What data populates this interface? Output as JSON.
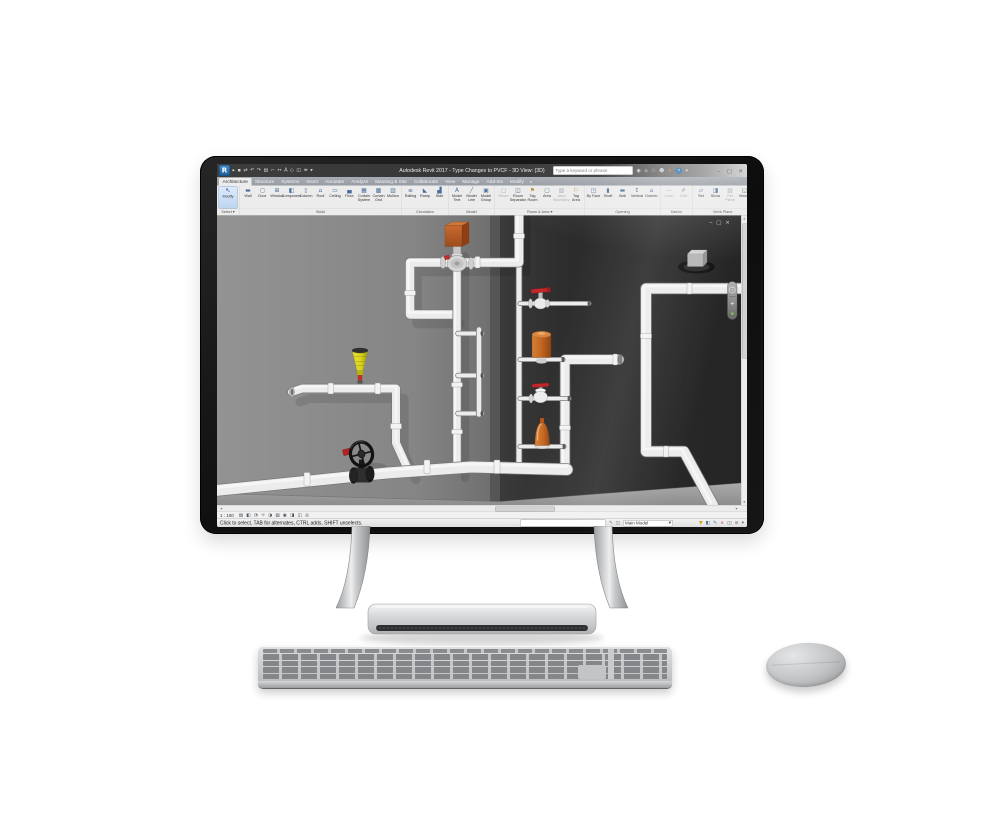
{
  "window": {
    "app_button": "R",
    "title": "Autodesk Revit 2017 - Type Changes to PVCF - 3D View: {3D}",
    "search_placeholder": "Type a keyword or phrase",
    "qat_icons": [
      {
        "name": "open",
        "glyph": "▸"
      },
      {
        "name": "save",
        "glyph": "▪"
      },
      {
        "name": "sync",
        "glyph": "⇄"
      },
      {
        "name": "undo",
        "glyph": "↶"
      },
      {
        "name": "redo",
        "glyph": "↷"
      },
      {
        "name": "print",
        "glyph": "▤"
      },
      {
        "name": "measure",
        "glyph": "⌐"
      },
      {
        "name": "aligned-dimension",
        "glyph": "↔"
      },
      {
        "name": "text",
        "glyph": "A"
      },
      {
        "name": "default-3d-view",
        "glyph": "◇"
      },
      {
        "name": "section",
        "glyph": "◫"
      },
      {
        "name": "thin-lines",
        "glyph": "≡"
      },
      {
        "name": "qat-menu",
        "glyph": "▾"
      }
    ],
    "infocenter_icons": [
      {
        "name": "search-go",
        "glyph": "◉"
      },
      {
        "name": "subscription-center",
        "glyph": "⌂"
      },
      {
        "name": "favorites",
        "glyph": "☆"
      },
      {
        "name": "sign-in",
        "glyph": "☻"
      },
      {
        "name": "exchange-apps",
        "glyph": "×"
      },
      {
        "name": "help-menu",
        "glyph": "▾"
      }
    ],
    "help_label": "?",
    "controls": {
      "minimize": "–",
      "maximize": "▢",
      "close": "×"
    }
  },
  "ribbon": {
    "tabs": [
      "Architecture",
      "Structure",
      "Systems",
      "Insert",
      "Annotate",
      "Analyze",
      "Massing & Site",
      "Collaborate",
      "View",
      "Manage",
      "Add-Ins",
      "Modify"
    ],
    "tab_caret": "▾",
    "panels": [
      {
        "name": "Select ▾",
        "buttons": [
          {
            "label": "Modify",
            "icon": "↖"
          }
        ]
      },
      {
        "name": "Build",
        "buttons": [
          {
            "label": "Wall",
            "icon": "▬"
          },
          {
            "label": "Door",
            "icon": "◻"
          },
          {
            "label": "Window",
            "icon": "⊞"
          },
          {
            "label": "Component",
            "icon": "◧"
          },
          {
            "label": "Column",
            "icon": "▯"
          },
          {
            "label": "Roof",
            "icon": "⌂"
          },
          {
            "label": "Ceiling",
            "icon": "▭"
          },
          {
            "label": "Floor",
            "icon": "▄"
          },
          {
            "label": "Curtain System",
            "icon": "▦"
          },
          {
            "label": "Curtain Grid",
            "icon": "▩"
          },
          {
            "label": "Mullion",
            "icon": "▥"
          }
        ]
      },
      {
        "name": "Circulation",
        "buttons": [
          {
            "label": "Railing",
            "icon": "≡"
          },
          {
            "label": "Ramp",
            "icon": "◣"
          },
          {
            "label": "Stair",
            "icon": "▟"
          }
        ]
      },
      {
        "name": "Model",
        "buttons": [
          {
            "label": "Model Text",
            "icon": "A"
          },
          {
            "label": "Model Line",
            "icon": "╱"
          },
          {
            "label": "Model Group",
            "icon": "▣"
          }
        ]
      },
      {
        "name": "Room & Area ▾",
        "buttons": [
          {
            "label": "Room",
            "icon": "□"
          },
          {
            "label": "Room Separator",
            "icon": "◫"
          },
          {
            "label": "Tag Room",
            "icon": "⚑"
          },
          {
            "label": "Area",
            "icon": "▢"
          },
          {
            "label": "Area Boundary",
            "icon": "▧"
          },
          {
            "label": "Tag Area",
            "icon": "⚐"
          }
        ]
      },
      {
        "name": "Opening",
        "buttons": [
          {
            "label": "By Face",
            "icon": "◳"
          },
          {
            "label": "Shaft",
            "icon": "▮"
          },
          {
            "label": "Wall",
            "icon": "▬"
          },
          {
            "label": "Vertical",
            "icon": "↕"
          },
          {
            "label": "Dormer",
            "icon": "⌂"
          }
        ]
      },
      {
        "name": "Datum",
        "buttons": [
          {
            "label": "Level",
            "icon": "—"
          },
          {
            "label": "Grid",
            "icon": "#"
          }
        ]
      },
      {
        "name": "Work Plane",
        "buttons": [
          {
            "label": "Set",
            "icon": "▱"
          },
          {
            "label": "Show",
            "icon": "◨"
          },
          {
            "label": "Ref Plane",
            "icon": "▨"
          },
          {
            "label": "Viewer",
            "icon": "◱"
          }
        ]
      }
    ]
  },
  "viewport": {
    "window_controls": "‒ ▢ ×"
  },
  "view_control_bar": {
    "scale": "1 : 100",
    "icons": [
      {
        "name": "detail-level",
        "glyph": "▤"
      },
      {
        "name": "visual-style",
        "glyph": "◧"
      },
      {
        "name": "sun-path",
        "glyph": "◔"
      },
      {
        "name": "shadows",
        "glyph": "☼"
      },
      {
        "name": "render",
        "glyph": "◑"
      },
      {
        "name": "crop-view",
        "glyph": "▧"
      },
      {
        "name": "crop-region-visible",
        "glyph": "◉"
      },
      {
        "name": "temporary-hide-isolate",
        "glyph": "◨"
      },
      {
        "name": "reveal-hidden-elements",
        "glyph": "◫"
      },
      {
        "name": "worksharing-display",
        "glyph": "◎"
      }
    ]
  },
  "status_bar": {
    "hint": "Click to select, TAB for alternates, CTRL adds, SHIFT unselects.",
    "edit_icons": [
      {
        "name": "editable-only",
        "glyph": "✎"
      },
      {
        "name": "worksets",
        "glyph": "◫"
      }
    ],
    "design_option": "Main Model",
    "combo_caret": "▾",
    "right_icons": [
      {
        "name": "filter",
        "glyph": "▼",
        "color": "#d9a300"
      },
      {
        "name": "editable-only-toggle",
        "glyph": "◧",
        "color": "#4a6f9a"
      },
      {
        "name": "edit-requests",
        "glyph": "✎",
        "color": "#4a6f9a"
      },
      {
        "name": "warnings",
        "glyph": "×",
        "color": "#b03030"
      },
      {
        "name": "select-links",
        "glyph": "◫",
        "color": "#666666"
      },
      {
        "name": "select-pinned",
        "glyph": "⊘",
        "color": "#666666"
      },
      {
        "name": "drag-on-selection",
        "glyph": "▾",
        "color": "#666666"
      }
    ],
    "scroll_glyphs": {
      "up": "▴",
      "down": "▾",
      "left": "◂",
      "right": "▸"
    }
  },
  "colors": {
    "accent_blue": "#2e74b5",
    "valve_orange": "#c2661f",
    "valve_yellow": "#d9d21c",
    "valve_red": "#c1272b",
    "wall_light": "#8c8c8c",
    "wall_dark": "#2c2c2c"
  }
}
